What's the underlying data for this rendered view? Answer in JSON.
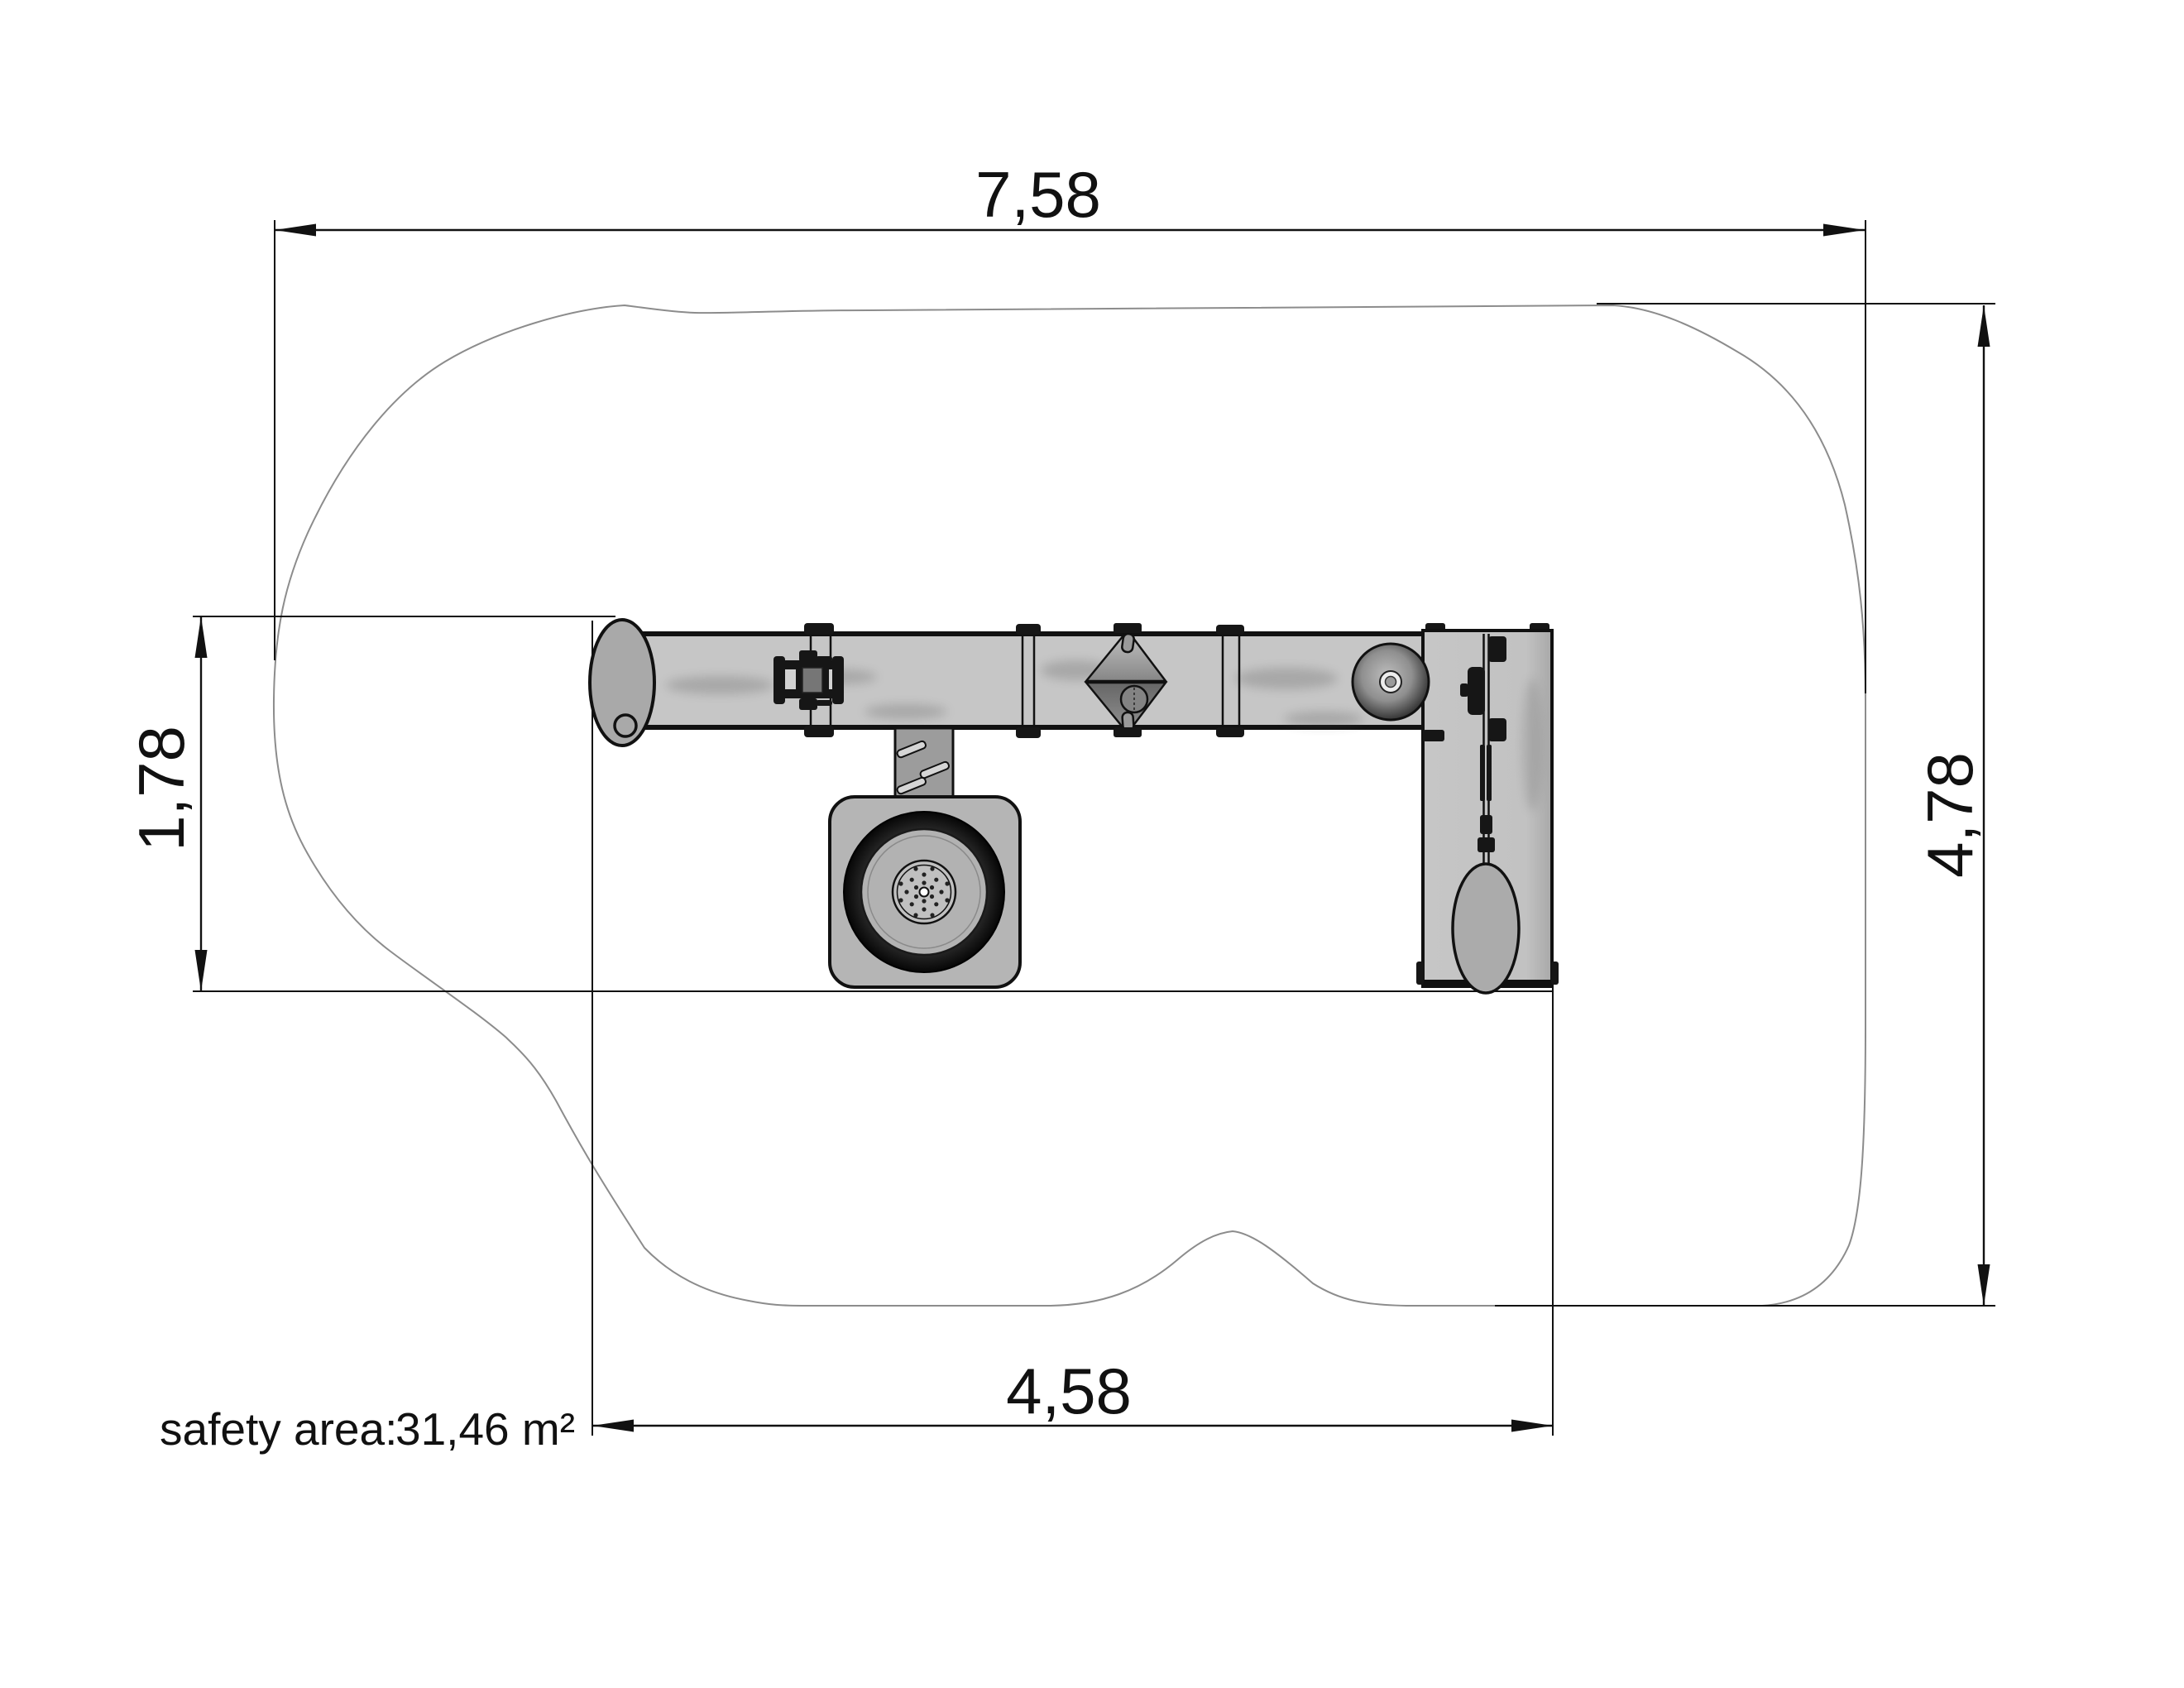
{
  "dimensions": {
    "top": {
      "label": "7,58"
    },
    "right": {
      "label": "4,78"
    },
    "left": {
      "label": "1,78"
    },
    "bottom": {
      "label": "4,58"
    }
  },
  "safety_area": {
    "label": "safety area:",
    "value": "31,46 m²"
  },
  "colors": {
    "ink": "#111111",
    "blob-outline": "#8c8c8c",
    "metal-light": "#c6c6c6",
    "metal-mid": "#a9a9a9",
    "hardware-dark": "#161616",
    "background": "#ffffff"
  }
}
